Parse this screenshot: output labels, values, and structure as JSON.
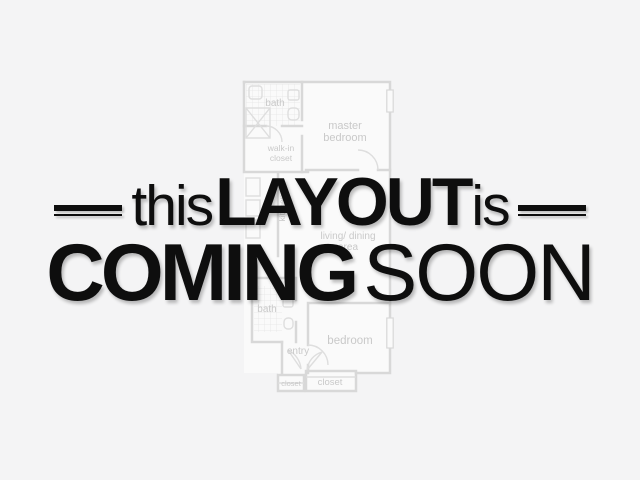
{
  "page": {
    "background_color": "#f4f4f5",
    "text_color": "#0e0e0e",
    "shadow_color": "rgba(0,0,0,0.25)"
  },
  "overlay": {
    "line1": {
      "word1": "this",
      "word2": "LAYOUT",
      "word3": "is"
    },
    "line2": {
      "word1": "COMING",
      "word2": "SOON"
    }
  },
  "floor_plan": {
    "stroke_color": "#d8d8d8",
    "label_color": "#c9c9c9",
    "labels": {
      "bath_upper": "bath",
      "master_bedroom_1": "master",
      "master_bedroom_2": "bedroom",
      "walk_in_1": "walk-in",
      "walk_in_2": "closet",
      "kitchen": "kitchen",
      "living_1": "living/ dining",
      "living_2": "area",
      "bath_lower": "bath",
      "bedroom": "bedroom",
      "entry": "entry",
      "closet_small": "closet",
      "closet_large": "closet"
    }
  }
}
